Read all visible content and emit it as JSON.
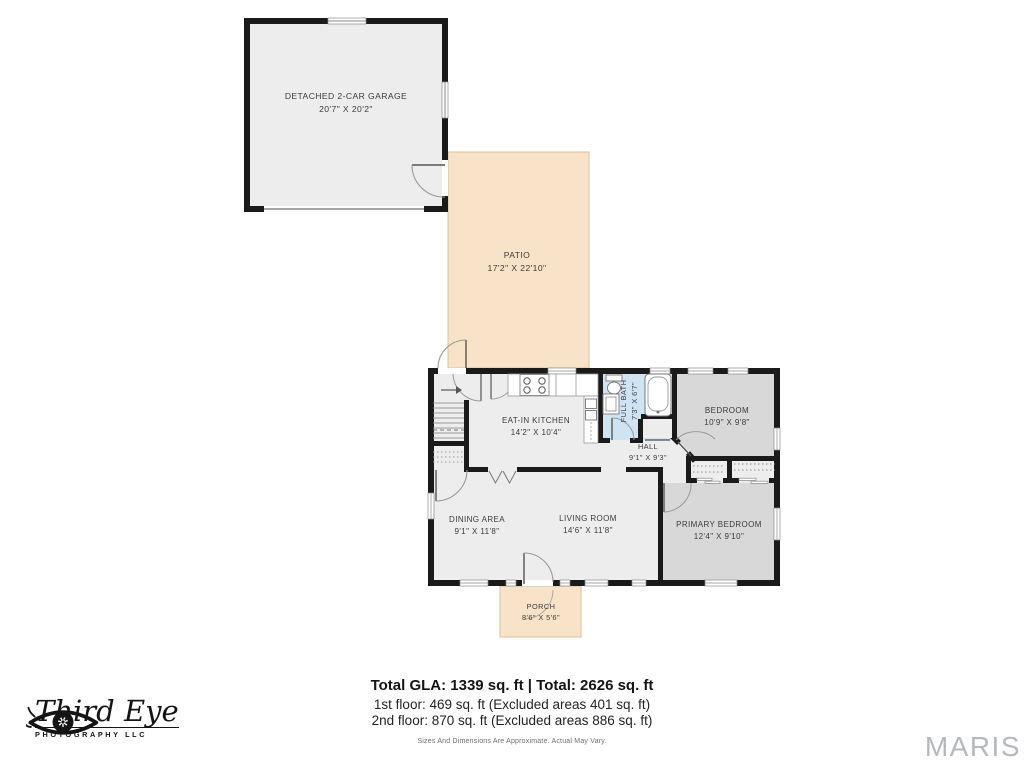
{
  "plan": {
    "rooms": {
      "garage": {
        "name": "Detached 2-car Garage",
        "dims": "20'7\" x 20'2\""
      },
      "patio": {
        "name": "Patio",
        "dims": "17'2\" x 22'10\""
      },
      "kitchen": {
        "name": "Eat-in Kitchen",
        "dims": "14'2\" x 10'4\""
      },
      "full_bath": {
        "name": "Full Bath",
        "dims": "7'3\" x 6'7\""
      },
      "hall": {
        "name": "Hall",
        "dims": "9'1\" x 9'3\""
      },
      "bedroom": {
        "name": "Bedroom",
        "dims": "10'9\" x 9'8\""
      },
      "dining": {
        "name": "Dining Area",
        "dims": "9'1\" x 11'8\""
      },
      "living": {
        "name": "Living Room",
        "dims": "14'6\" x 11'8\""
      },
      "primary": {
        "name": "Primary Bedroom",
        "dims": "12'4\" x 9'10\""
      },
      "porch": {
        "name": "Porch",
        "dims": "8'6\" x 5'6\""
      }
    }
  },
  "summary": {
    "totals": "Total GLA: 1339 sq. ft | Total: 2626 sq. ft",
    "first_floor": "1st floor: 469 sq. ft (Excluded areas 401 sq. ft)",
    "second_floor": "2nd floor: 870 sq. ft (Excluded areas 886 sq. ft)",
    "disclaimer": "Sizes And Dimensions Are Approximate. Actual May Vary."
  },
  "branding": {
    "studio_name": "Third Eye",
    "studio_sub": "PHOTOGRAPHY LLC",
    "watermark": "MARIS"
  },
  "colors": {
    "wall": "#1a1a1a",
    "floor": "#ededed",
    "bedroom_fill": "#d8d8d8",
    "bath_fill": "#cfe4f3",
    "outdoor_fill": "#f9e3c8",
    "watermark_color": "#b5b8bc"
  }
}
